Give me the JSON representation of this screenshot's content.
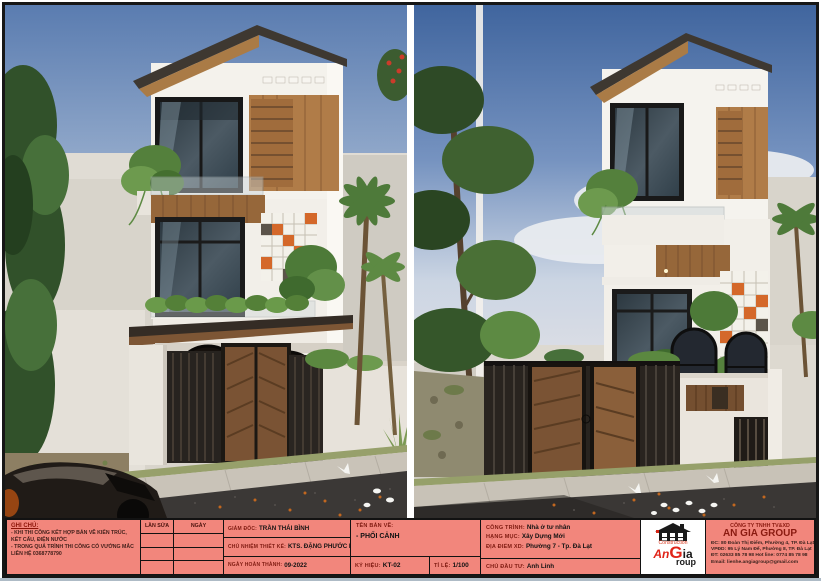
{
  "sheet": {
    "panels": [
      {
        "name": "perspective-view-left",
        "description": "front perspective render of three-storey townhouse"
      },
      {
        "name": "perspective-view-right",
        "description": "angled perspective render of the same townhouse"
      }
    ]
  },
  "title_block": {
    "notes": {
      "heading": "GHI CHÚ:",
      "lines": [
        "- KHI THI CÔNG KẾT HỢP BẢN VẼ KIẾN TRÚC, KẾT CẤU, ĐIỆN NƯỚC",
        "- TRONG QUÁ TRÌNH THI CÔNG CÓ VƯỚNG MẮC LIÊN HỆ 0368778790"
      ]
    },
    "revisions": {
      "col_revision": "LẦN SỬA",
      "col_date": "NGÀY"
    },
    "management": {
      "director_label": "GIÁM ĐỐC:",
      "director": "TRẦN THÁI BÌNH",
      "design_lead_label": "CHỦ NHIỆM THIẾT KẾ:",
      "design_lead": "KTS. ĐẶNG PHƯỚC KHANG",
      "completion_label": "NGÀY HOÀN THÀNH:",
      "completion": "09-2022"
    },
    "drawing": {
      "name_label": "TÊN BẢN VẼ:",
      "name": "- PHỐI CẢNH",
      "code_label": "KÝ HIỆU:",
      "code": "KT-02",
      "scale_label": "TỈ LỆ:",
      "scale": "1/100"
    },
    "project": {
      "work_label": "CÔNG TRÌNH:",
      "work": "Nhà ở tư nhân",
      "category_label": "HẠNG MỤC:",
      "category": "Xây Dựng Mới",
      "location_label": "ĐỊA ĐIỂM XD:",
      "location": "Phường 7 - Tp. Đà Lạt",
      "client_label": "CHỦ ĐẦU TƯ:",
      "client": "Anh Linh"
    },
    "logo": {
      "construction": "Construction",
      "an": "An",
      "g": "G",
      "ia": "ia",
      "roup": "roup"
    },
    "company": {
      "type": "CÔNG TY TNHH TV&XD",
      "name": "AN GIA GROUP",
      "address1": "ĐC: 80 Đoàn Thị Điểm, Phường 4, TP. Đà Lạt",
      "address2": "VPĐD: 95 Lý Nam Đế, Phường 8, TP. Đà Lạt",
      "phone": "ĐT: 02633 85 78 98    Hot line: 0774 85 78 98",
      "email": "Email: lienhe.angiagroup@gmail.com"
    }
  },
  "palette": {
    "title_block_bg": "#f2867c",
    "label_maroon": "#7e1a10",
    "logo_red": "#e02418",
    "wood": "#aa7b46",
    "orange_accent": "#d4682a",
    "sky_blue": "#5a7cb0",
    "road": "#3b3836"
  }
}
